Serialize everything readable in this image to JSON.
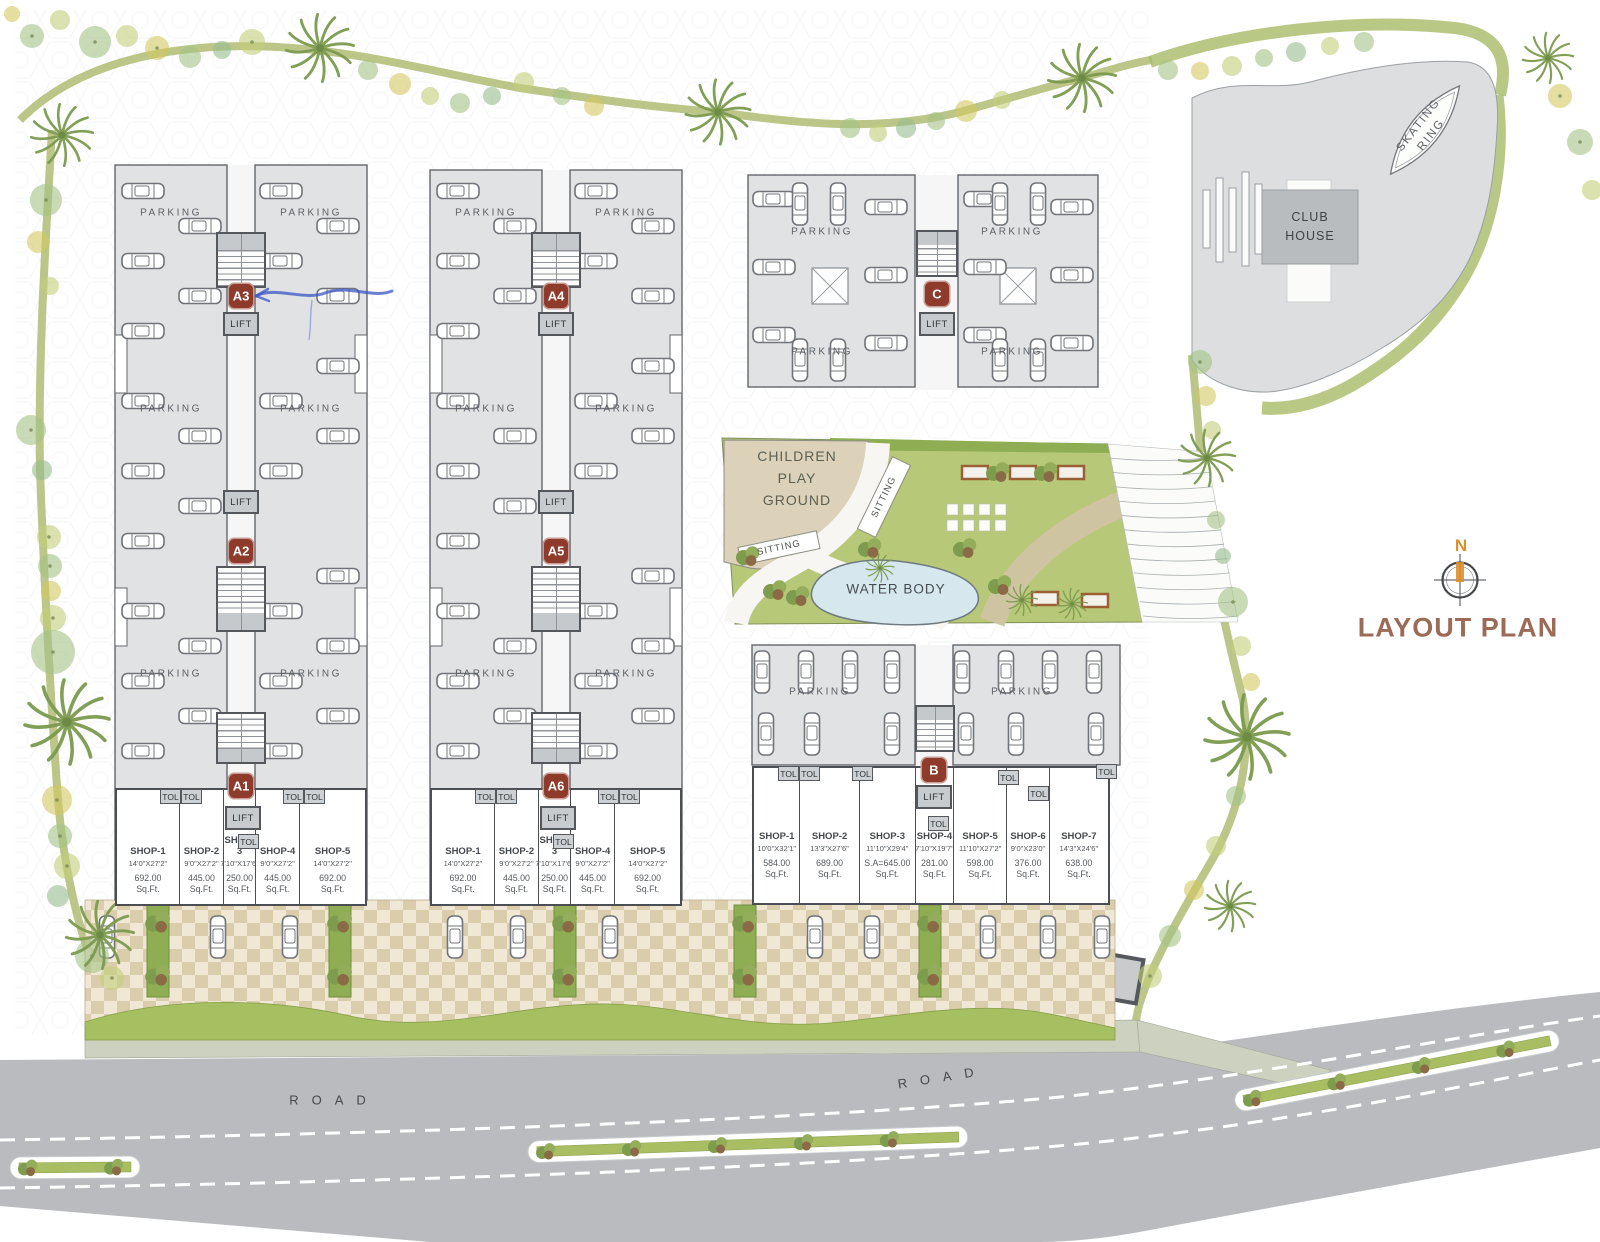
{
  "title": {
    "layout_plan": "LAYOUT PLAN",
    "north": "N"
  },
  "strings": {
    "parking": "PARKING",
    "lift": "LIFT",
    "tol": "TOL",
    "road": "ROAD",
    "sitting": "SITTING",
    "water_body": "WATER BODY",
    "sqft": "Sq.Ft."
  },
  "children_play_ground": {
    "line1": "CHILDREN",
    "line2": "PLAY",
    "line3": "GROUND"
  },
  "club_house": {
    "line1": "CLUB",
    "line2": "HOUSE"
  },
  "skating_ring": {
    "line1": "SKATING",
    "line2": "RING"
  },
  "blocks": {
    "badges": {
      "a1": "A1",
      "a2": "A2",
      "a3": "A3",
      "a4": "A4",
      "a5": "A5",
      "a6": "A6",
      "b": "B",
      "c": "C"
    }
  },
  "shop_blocks": [
    {
      "id": "a1",
      "shops": [
        {
          "name": "SHOP-1",
          "dim": "14'0\"X27'2\"",
          "area": "692.00"
        },
        {
          "name": "SHOP-2",
          "dim": "9'0\"X27'2\"",
          "area": "445.00"
        },
        {
          "name": "SHOP-3",
          "dim": "7'10\"X17'6\"",
          "area": "250.00"
        },
        {
          "name": "SHOP-4",
          "dim": "9'0\"X27'2\"",
          "area": "445.00"
        },
        {
          "name": "SHOP-5",
          "dim": "14'0\"X27'2\"",
          "area": "692.00"
        }
      ]
    },
    {
      "id": "a6",
      "shops": [
        {
          "name": "SHOP-1",
          "dim": "14'0\"X27'2\"",
          "area": "692.00"
        },
        {
          "name": "SHOP-2",
          "dim": "9'0\"X27'2\"",
          "area": "445.00"
        },
        {
          "name": "SHOP-3",
          "dim": "7'10\"X17'6\"",
          "area": "250.00"
        },
        {
          "name": "SHOP-4",
          "dim": "9'0\"X27'2\"",
          "area": "445.00"
        },
        {
          "name": "SHOP-5",
          "dim": "14'0\"X27'2\"",
          "area": "692.00"
        }
      ]
    },
    {
      "id": "b",
      "shops": [
        {
          "name": "SHOP-1",
          "dim": "10'0\"X32'1\"",
          "area": "584.00"
        },
        {
          "name": "SHOP-2",
          "dim": "13'3\"X27'6\"",
          "area": "689.00"
        },
        {
          "name": "SHOP-3",
          "dim": "11'10\"X29'4\"",
          "area": "S.A=645.00"
        },
        {
          "name": "SHOP-4",
          "dim": "7'10\"X19'7\"",
          "area": "281.00"
        },
        {
          "name": "SHOP-5",
          "dim": "11'10\"X27'2\"",
          "area": "598.00"
        },
        {
          "name": "SHOP-6",
          "dim": "9'0\"X23'0\"",
          "area": "376.00"
        },
        {
          "name": "SHOP-7",
          "dim": "14'3\"X24'6\"",
          "area": "638.00"
        }
      ]
    }
  ],
  "colors": {
    "badge_bg": "#8e3b2b",
    "title": "#9b6b57",
    "north": "#dd8f2e",
    "lawn": "#b7c878",
    "water": "#d6e8ee",
    "road": "#b9bbbf",
    "parking_fill": "#e0e2e4",
    "checker": "#dacdab"
  }
}
